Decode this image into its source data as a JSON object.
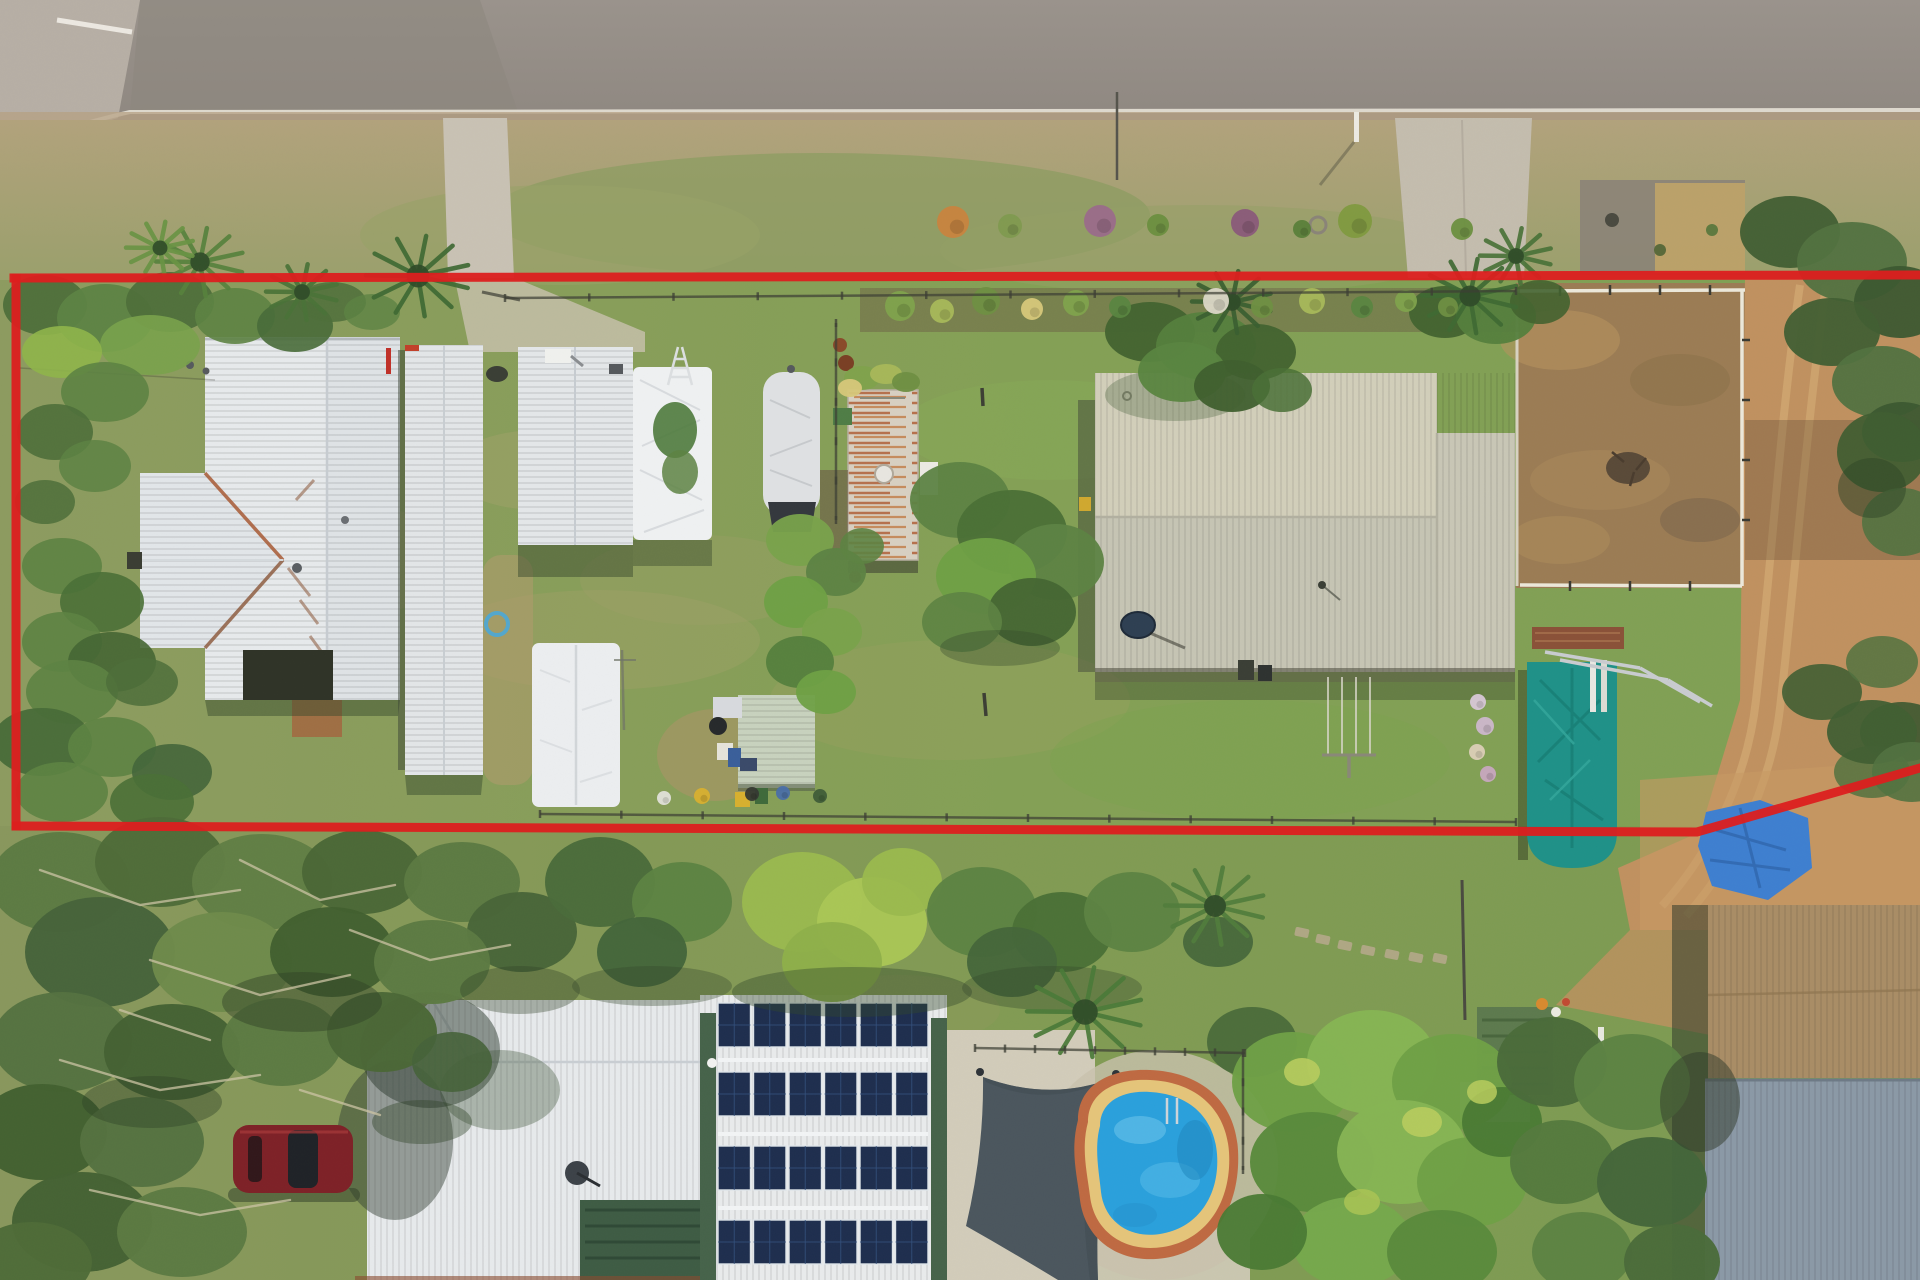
{
  "meta": {
    "title": "Aerial drone photo of a rural residential property with a red boundary outline",
    "description": "Top-down aerial photograph: road along top, long grassy block outlined in red containing a white-roofed house, long shed, carports, covered boat, rusty caravan, large cream shed, fenced dirt yard, teal tarp structure; neighbouring property below with solar-panel roof, shade sail and kidney pool"
  },
  "palette": {
    "road": "#98918a",
    "road2": "#8e8780",
    "concrete": "#b7afa5",
    "curb": "#e7e2d6",
    "dirt_strip": "#b5a083",
    "verge": "#ab9d74",
    "verge_green": "#8c9c62",
    "lawn": "#869c5a",
    "lawn2": "#7da452",
    "olive": "#97a064",
    "tan_patch": "#a7a06c",
    "roof_white": "#e7eaec",
    "roof_white2": "#dfe3e6",
    "roof_line": "#c7ccd1",
    "rust": "#a85a34",
    "gable": "#e2e6e9",
    "shed": "#e3e6e8",
    "tarp": "#eff1f2",
    "boat": "#dfe1e3",
    "boat_base": "#34383d",
    "caravan": "#d8d0c2",
    "rust_streak": "#b06038",
    "beige1": "#d2cfba",
    "beige2": "#c6c5b4",
    "eave": "#4a493c",
    "teal": "#1f9188",
    "teal_dark": "#157a72",
    "bluetarp": "#3e7fd0",
    "pool": "#2aa0dc",
    "pool_light": "#6ec6ec",
    "coping": "#e5c57a",
    "brick": "#bf6a42",
    "sail": "#4b565e",
    "solar": "#1e2e4e",
    "solarline": "#34517e",
    "trim_green": "#46634a",
    "pergola": "#3e5c44",
    "deck": "#d2ccba",
    "dirt": "#c09160",
    "dirt2": "#b08450",
    "yard": "#9b7c54",
    "tanroof": "#a98d66",
    "blueroof": "#8b99a6",
    "shedgreen": "#5d7a4e",
    "car": "#7e2127",
    "boundary": "#dc1f1f",
    "fence": "#3c3e34",
    "rail": "#ece8da",
    "shadow": "#33482a",
    "branch": "#ccc4a4",
    "mulch": "#6b5a44",
    "path_dirt": "#a4643f"
  },
  "scene": {
    "blobs": [
      [
        45,
        305,
        42,
        30,
        "#4e6f3a",
        0.95
      ],
      [
        105,
        318,
        48,
        34,
        "#5d8343",
        0.95
      ],
      [
        170,
        302,
        44,
        30,
        "#4e6f3a",
        0.95
      ],
      [
        235,
        316,
        40,
        28,
        "#5d8343",
        0.9
      ],
      [
        295,
        326,
        38,
        26,
        "#486b38",
        0.9
      ],
      [
        150,
        345,
        50,
        30,
        "#79a24b",
        0.9
      ],
      [
        62,
        352,
        40,
        26,
        "#8fb54a",
        0.9
      ],
      [
        105,
        392,
        44,
        30,
        "#5d8343",
        0.9
      ],
      [
        55,
        432,
        38,
        28,
        "#4e6f3a",
        0.9
      ],
      [
        95,
        466,
        36,
        26,
        "#5d8343",
        0.85
      ],
      [
        45,
        502,
        30,
        22,
        "#4e6f3a",
        0.85
      ],
      [
        62,
        566,
        40,
        28,
        "#5d8343",
        0.9
      ],
      [
        102,
        602,
        42,
        30,
        "#4a7036",
        0.9
      ],
      [
        62,
        642,
        40,
        30,
        "#5d8343",
        0.9
      ],
      [
        112,
        662,
        44,
        30,
        "#456633",
        0.9
      ],
      [
        72,
        692,
        46,
        32,
        "#5d8343",
        0.9
      ],
      [
        142,
        682,
        36,
        24,
        "#4e6f3a",
        0.85
      ],
      [
        42,
        742,
        50,
        34,
        "#486b38",
        0.95
      ],
      [
        112,
        747,
        44,
        30,
        "#5d8343",
        0.9
      ],
      [
        172,
        772,
        40,
        28,
        "#44663a",
        0.9
      ],
      [
        62,
        792,
        46,
        30,
        "#5d8343",
        0.9
      ],
      [
        152,
        802,
        42,
        28,
        "#4a7036",
        0.9
      ],
      [
        332,
        302,
        34,
        20,
        "#4e6f3a",
        0.85
      ],
      [
        372,
        312,
        28,
        18,
        "#5d8343",
        0.8
      ],
      [
        800,
        540,
        34,
        26,
        "#79a24b",
        0.95
      ],
      [
        836,
        572,
        30,
        24,
        "#5d8343",
        0.95
      ],
      [
        796,
        602,
        32,
        26,
        "#6fa045",
        0.95
      ],
      [
        832,
        632,
        30,
        24,
        "#79a24b",
        0.95
      ],
      [
        800,
        662,
        34,
        26,
        "#55803d",
        0.95
      ],
      [
        826,
        692,
        30,
        22,
        "#6fa045",
        0.95
      ],
      [
        862,
        546,
        22,
        18,
        "#5d8343",
        0.9
      ],
      [
        675,
        430,
        22,
        28,
        "#4e7a3c",
        0.9
      ],
      [
        680,
        472,
        18,
        22,
        "#5d8343",
        0.85
      ],
      [
        960,
        500,
        50,
        38,
        "#5d8343",
        0.95
      ],
      [
        1012,
        532,
        55,
        42,
        "#4a7036",
        0.95
      ],
      [
        1056,
        562,
        48,
        38,
        "#5d8343",
        0.95
      ],
      [
        986,
        576,
        50,
        38,
        "#6fa045",
        0.95
      ],
      [
        1032,
        612,
        44,
        34,
        "#456633",
        0.95
      ],
      [
        962,
        622,
        40,
        30,
        "#5d8343",
        0.9
      ],
      [
        1000,
        648,
        60,
        18,
        "#33482a",
        0.35
      ],
      [
        1150,
        332,
        45,
        30,
        "#42632f",
        0.95
      ],
      [
        1206,
        346,
        50,
        34,
        "#55803d",
        0.95
      ],
      [
        1256,
        352,
        40,
        28,
        "#42632f",
        0.95
      ],
      [
        1182,
        372,
        44,
        30,
        "#5a8540",
        0.95
      ],
      [
        1232,
        386,
        38,
        26,
        "#3f5f2e",
        0.95
      ],
      [
        1282,
        390,
        30,
        22,
        "#4a7036",
        0.85
      ],
      [
        1445,
        312,
        36,
        26,
        "#42632f",
        0.95
      ],
      [
        1496,
        316,
        40,
        28,
        "#55803d",
        0.95
      ],
      [
        1540,
        302,
        30,
        22,
        "#42632f",
        0.9
      ],
      [
        1790,
        232,
        50,
        36,
        "#415f33",
        0.95
      ],
      [
        1852,
        262,
        55,
        40,
        "#527240",
        0.95
      ],
      [
        1900,
        302,
        46,
        36,
        "#3c5830",
        0.95
      ],
      [
        1832,
        332,
        48,
        34,
        "#415f33",
        0.95
      ],
      [
        1882,
        382,
        50,
        36,
        "#527240",
        0.95
      ],
      [
        1902,
        432,
        40,
        30,
        "#3c5830",
        0.95
      ],
      [
        1882,
        452,
        45,
        40,
        "#3f5d31",
        0.92
      ],
      [
        1902,
        522,
        40,
        34,
        "#527240",
        0.9
      ],
      [
        1872,
        488,
        34,
        30,
        "#2e4526",
        0.5
      ],
      [
        1822,
        692,
        40,
        28,
        "#415f33",
        0.9
      ],
      [
        1882,
        662,
        36,
        26,
        "#527240",
        0.85
      ],
      [
        1902,
        732,
        42,
        30,
        "#3c5830",
        0.9
      ],
      [
        1872,
        772,
        38,
        26,
        "#527240",
        0.85
      ],
      [
        60,
        882,
        70,
        50,
        "#5c7a42",
        0.97
      ],
      [
        160,
        862,
        65,
        45,
        "#4e6b38",
        0.97
      ],
      [
        262,
        882,
        70,
        48,
        "#617e44",
        0.97
      ],
      [
        362,
        872,
        60,
        42,
        "#4a6736",
        0.97
      ],
      [
        462,
        882,
        58,
        40,
        "#5c7a42",
        0.97
      ],
      [
        522,
        932,
        55,
        40,
        "#486538",
        0.97
      ],
      [
        100,
        952,
        75,
        55,
        "#46633a",
        0.97
      ],
      [
        222,
        962,
        70,
        50,
        "#6e8a4a",
        0.97
      ],
      [
        332,
        952,
        62,
        45,
        "#42602f",
        0.97
      ],
      [
        432,
        962,
        58,
        42,
        "#5c7a42",
        0.97
      ],
      [
        62,
        1042,
        70,
        50,
        "#557240",
        0.97
      ],
      [
        172,
        1052,
        68,
        48,
        "#446133",
        0.97
      ],
      [
        282,
        1042,
        60,
        44,
        "#5c7a42",
        0.97
      ],
      [
        382,
        1032,
        55,
        40,
        "#4a6736",
        0.97
      ],
      [
        42,
        1132,
        65,
        48,
        "#42602f",
        0.97
      ],
      [
        142,
        1142,
        62,
        45,
        "#557240",
        0.97
      ],
      [
        82,
        1222,
        70,
        50,
        "#446133",
        0.97
      ],
      [
        182,
        1232,
        65,
        45,
        "#5c7a42",
        0.97
      ],
      [
        32,
        1262,
        60,
        40,
        "#4e6b38",
        0.97
      ],
      [
        452,
        1062,
        40,
        30,
        "#46633a",
        0.9
      ],
      [
        302,
        1002,
        80,
        30,
        "#2e4026",
        0.45
      ],
      [
        152,
        1102,
        70,
        26,
        "#2e4026",
        0.4
      ],
      [
        422,
        1122,
        50,
        22,
        "#2e4026",
        0.4
      ],
      [
        520,
        990,
        60,
        24,
        "#2e4026",
        0.35
      ],
      [
        600,
        882,
        55,
        45,
        "#4a6b3a",
        0.96
      ],
      [
        682,
        902,
        50,
        40,
        "#5d8343",
        0.96
      ],
      [
        642,
        952,
        45,
        35,
        "#44663a",
        0.96
      ],
      [
        802,
        902,
        60,
        50,
        "#9ab94e",
        0.97
      ],
      [
        872,
        922,
        55,
        45,
        "#aac755",
        0.96
      ],
      [
        832,
        962,
        50,
        40,
        "#8fb04a",
        0.96
      ],
      [
        902,
        882,
        40,
        34,
        "#9ab94e",
        0.95
      ],
      [
        982,
        912,
        55,
        45,
        "#5d8343",
        0.96
      ],
      [
        1062,
        932,
        50,
        40,
        "#4a7036",
        0.96
      ],
      [
        1132,
        912,
        48,
        40,
        "#5d8343",
        0.96
      ],
      [
        1012,
        962,
        45,
        35,
        "#44663a",
        0.95
      ],
      [
        1218,
        942,
        35,
        25,
        "#44663a",
        0.9
      ],
      [
        1252,
        1042,
        45,
        35,
        "#4a6b3a",
        0.95
      ],
      [
        852,
        992,
        120,
        25,
        "#33482a",
        0.4
      ],
      [
        1052,
        988,
        90,
        22,
        "#33482a",
        0.35
      ],
      [
        652,
        986,
        80,
        20,
        "#33482a",
        0.35
      ],
      [
        1292,
        1082,
        60,
        50,
        "#6fa046",
        0.97
      ],
      [
        1372,
        1062,
        65,
        52,
        "#86b554",
        0.97
      ],
      [
        1452,
        1082,
        60,
        48,
        "#6fa046",
        0.97
      ],
      [
        1312,
        1162,
        62,
        50,
        "#5a8a3c",
        0.97
      ],
      [
        1402,
        1152,
        65,
        52,
        "#86b554",
        0.97
      ],
      [
        1472,
        1182,
        55,
        45,
        "#6fa046",
        0.97
      ],
      [
        1352,
        1242,
        60,
        45,
        "#76a84c",
        0.97
      ],
      [
        1442,
        1252,
        55,
        42,
        "#5a8a3c",
        0.97
      ],
      [
        1502,
        1122,
        40,
        35,
        "#4a7a34",
        0.95
      ],
      [
        1262,
        1232,
        45,
        38,
        "#4a7a34",
        0.95
      ],
      [
        1302,
        1072,
        18,
        14,
        "#b8cc5e",
        0.9
      ],
      [
        1422,
        1122,
        20,
        15,
        "#b8cc5e",
        0.9
      ],
      [
        1362,
        1202,
        18,
        13,
        "#aac455",
        0.85
      ],
      [
        1482,
        1092,
        15,
        12,
        "#b8cc5e",
        0.85
      ],
      [
        1552,
        1062,
        55,
        45,
        "#4a6b3a",
        0.97
      ],
      [
        1632,
        1082,
        58,
        48,
        "#5d8343",
        0.97
      ],
      [
        1562,
        1162,
        52,
        42,
        "#557a3e",
        0.97
      ],
      [
        1652,
        1182,
        55,
        45,
        "#44663a",
        0.97
      ],
      [
        1582,
        1252,
        50,
        40,
        "#5d8343",
        0.97
      ],
      [
        1672,
        1262,
        48,
        38,
        "#4a6b3a",
        0.97
      ],
      [
        1700,
        1102,
        40,
        50,
        "#2f3a2a",
        0.5
      ],
      [
        1872,
        732,
        45,
        32,
        "#415f33",
        0.95
      ],
      [
        1912,
        772,
        40,
        30,
        "#527240",
        0.9
      ],
      [
        862,
        378,
        18,
        12,
        "#7fa24c",
        0.95
      ],
      [
        886,
        374,
        16,
        10,
        "#a8b85a",
        0.95
      ],
      [
        906,
        382,
        14,
        10,
        "#6f8f42",
        0.95
      ],
      [
        850,
        388,
        12,
        9,
        "#d7c87a",
        0.95
      ]
    ],
    "palms": [
      [
        200,
        262,
        44,
        "#57823d"
      ],
      [
        418,
        276,
        52,
        "#3f6a33"
      ],
      [
        302,
        292,
        36,
        "#4a7338"
      ],
      [
        160,
        248,
        34,
        "#6a9444"
      ],
      [
        1470,
        296,
        48,
        "#3f6a33"
      ],
      [
        1516,
        256,
        36,
        "#4a7338"
      ],
      [
        1232,
        302,
        40,
        "#3a5f30"
      ],
      [
        1085,
        1012,
        58,
        "#4a7a38"
      ],
      [
        1215,
        906,
        50,
        "#517d3c"
      ]
    ],
    "branches": [
      [
        [
          40,
          870
        ],
        [
          140,
          905
        ],
        [
          240,
          890
        ]
      ],
      [
        [
          150,
          960
        ],
        [
          260,
          995
        ],
        [
          350,
          975
        ]
      ],
      [
        [
          60,
          1060
        ],
        [
          160,
          1090
        ],
        [
          260,
          1075
        ]
      ],
      [
        [
          240,
          860
        ],
        [
          320,
          900
        ],
        [
          395,
          885
        ]
      ],
      [
        [
          90,
          1190
        ],
        [
          200,
          1215
        ],
        [
          290,
          1200
        ]
      ],
      [
        [
          350,
          930
        ],
        [
          430,
          960
        ],
        [
          510,
          945
        ]
      ],
      [
        [
          120,
          1010
        ],
        [
          210,
          1040
        ]
      ],
      [
        [
          300,
          1090
        ],
        [
          380,
          1115
        ]
      ]
    ],
    "shrubs": [
      [
        953,
        222,
        16,
        "#c9843e"
      ],
      [
        1010,
        226,
        12,
        "#7f9a4f"
      ],
      [
        1100,
        221,
        16,
        "#9a6b8a"
      ],
      [
        1158,
        225,
        11,
        "#6b8f3f"
      ],
      [
        1245,
        223,
        14,
        "#8a5a7a"
      ],
      [
        1355,
        221,
        17,
        "#7f9a3f"
      ],
      [
        1302,
        229,
        9,
        "#5a7f3a"
      ],
      [
        1462,
        229,
        11,
        "#6b8f3f"
      ],
      [
        900,
        306,
        15,
        "#7fa24c"
      ],
      [
        942,
        311,
        12,
        "#a8b85a"
      ],
      [
        986,
        301,
        14,
        "#6f8f42"
      ],
      [
        1032,
        309,
        11,
        "#d7c87a"
      ],
      [
        1076,
        303,
        13,
        "#7fa24c"
      ],
      [
        1120,
        307,
        11,
        "#5a8540"
      ],
      [
        1216,
        301,
        13,
        "#dcd8c8"
      ],
      [
        1262,
        307,
        11,
        "#6f8f42"
      ],
      [
        1312,
        301,
        13,
        "#a8b85a"
      ],
      [
        1362,
        307,
        11,
        "#5a8540"
      ],
      [
        1406,
        301,
        11,
        "#7fa24c"
      ],
      [
        1448,
        307,
        10,
        "#6f8f42"
      ],
      [
        1478,
        702,
        8,
        "#d8c8d8"
      ],
      [
        1485,
        726,
        9,
        "#cdb8cd"
      ],
      [
        1477,
        752,
        8,
        "#dcd0b8"
      ],
      [
        1488,
        774,
        8,
        "#c8a8c0"
      ],
      [
        702,
        796,
        8,
        "#d8b02f"
      ],
      [
        664,
        798,
        7,
        "#e2e2da"
      ],
      [
        783,
        793,
        7,
        "#4a6fa8"
      ],
      [
        820,
        796,
        7,
        "#3f5d38"
      ],
      [
        752,
        794,
        7,
        "#353931"
      ]
    ],
    "stones": [
      [
        1302,
        932
      ],
      [
        1323,
        939
      ],
      [
        1345,
        945
      ],
      [
        1368,
        950
      ],
      [
        1392,
        954
      ],
      [
        1416,
        957
      ],
      [
        1440,
        958
      ]
    ],
    "fences": [
      {
        "x1": 505,
        "y1": 298,
        "x2": 1516,
        "y2": 291,
        "posts": 12
      },
      {
        "x1": 540,
        "y1": 814,
        "x2": 1516,
        "y2": 822,
        "posts": 12
      },
      {
        "x1": 975,
        "y1": 1048,
        "x2": 1245,
        "y2": 1053,
        "posts": 9
      },
      {
        "x1": 1243,
        "y1": 1053,
        "x2": 1243,
        "y2": 1170,
        "posts": 4
      },
      {
        "x1": 836,
        "y1": 323,
        "x2": 836,
        "y2": 520,
        "posts": 5
      }
    ],
    "solar": {
      "x": 718,
      "w": 210,
      "cols": 6,
      "h": 44,
      "bank_y": [
        1003,
        1072,
        1146,
        1220
      ],
      "panel_fill": "#1e2e4e",
      "gap": 3
    },
    "boundary": {
      "top": "14,278 1920,275",
      "left": "16,278 16,826",
      "bottom": "16,826 1697,832 1920,768",
      "width": 9
    }
  }
}
